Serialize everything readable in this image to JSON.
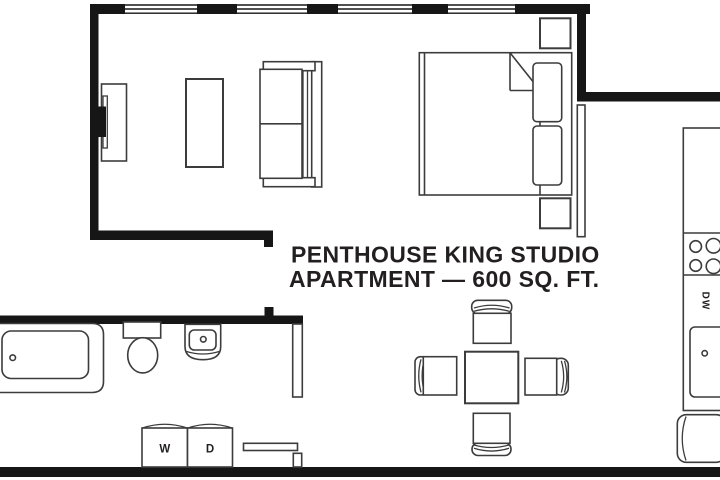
{
  "diagram": {
    "type": "floor-plan",
    "title": {
      "line1": "PENTHOUSE KING STUDIO",
      "line2": "APARTMENT — 600 SQ. FT."
    },
    "labels": {
      "washer": "W",
      "dryer": "D",
      "dishwasher": "DW"
    },
    "colors": {
      "background": "#ffffff",
      "wall": "#161616",
      "line": "#3c3c3c",
      "text": "#231f20"
    },
    "furniture_icons": [
      "tv-icon",
      "media-console-icon",
      "coffee-table-icon",
      "sofa-icon",
      "king-bed-icon",
      "pillow-icon",
      "nightstand-icon",
      "closet-partition-icon",
      "kitchen-counter-icon",
      "stove-burners-icon",
      "dishwasher-icon",
      "kitchen-sink-icon",
      "refrigerator-icon",
      "dining-table-icon",
      "dining-chair-icon",
      "bathtub-icon",
      "toilet-icon",
      "bathroom-sink-icon",
      "door-leaf-icon",
      "washer-icon",
      "dryer-icon",
      "bench-icon",
      "window-icon"
    ]
  }
}
